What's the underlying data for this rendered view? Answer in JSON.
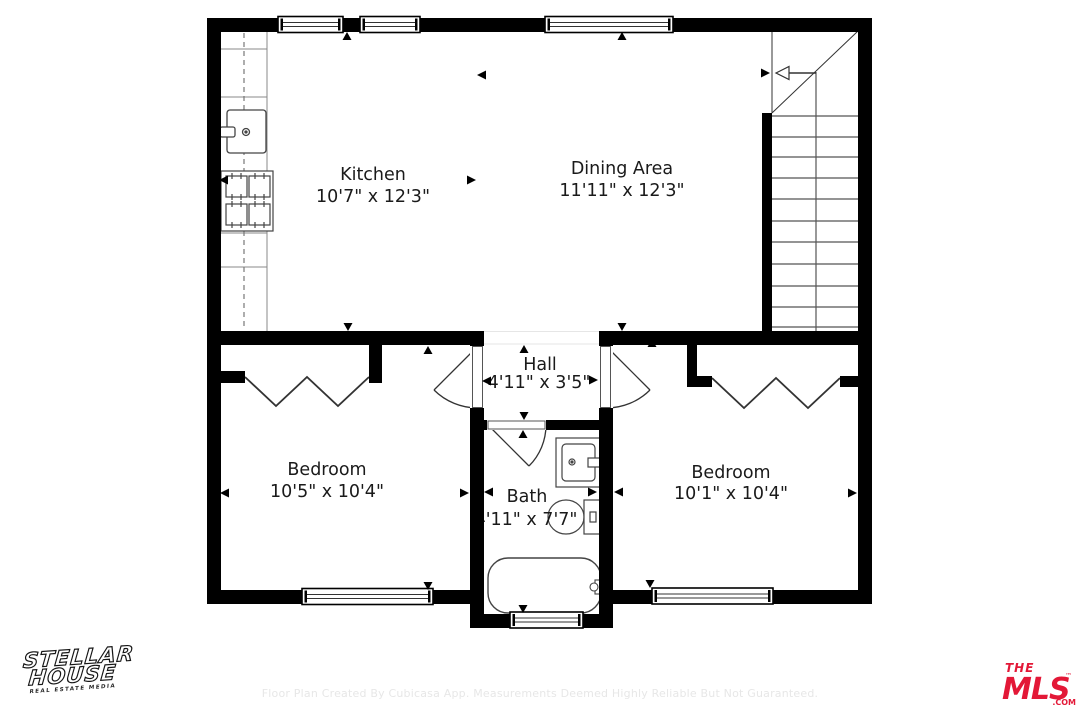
{
  "palette": {
    "wall": "#000000",
    "line": "#444444",
    "accent_red": "#e31837"
  },
  "rooms": [
    {
      "id": "kitchen",
      "name": "Kitchen",
      "dimensions": "10'7\" x 12'3\""
    },
    {
      "id": "dining-area",
      "name": "Dining Area",
      "dimensions": "11'11\" x 12'3\""
    },
    {
      "id": "hall",
      "name": "Hall",
      "dimensions": "4'11\" x 3'5\""
    },
    {
      "id": "bedroom-left",
      "name": "Bedroom",
      "dimensions": "10'5\" x 10'4\""
    },
    {
      "id": "bath",
      "name": "Bath",
      "dimensions": "4'11\" x 7'7\""
    },
    {
      "id": "bedroom-right",
      "name": "Bedroom",
      "dimensions": "10'1\" x 10'4\""
    }
  ],
  "branding": {
    "stellar_line1": "STELLAR",
    "stellar_line2": "HOUSE",
    "stellar_sub": "REAL ESTATE MEDIA",
    "mls_the": "THE",
    "mls_main": "MLS",
    "mls_tm": "™",
    "mls_com": ".COM"
  },
  "footer": {
    "disclaimer": "Floor Plan Created By Cubicasa App. Measurements Deemed Highly Reliable But Not Guaranteed."
  }
}
